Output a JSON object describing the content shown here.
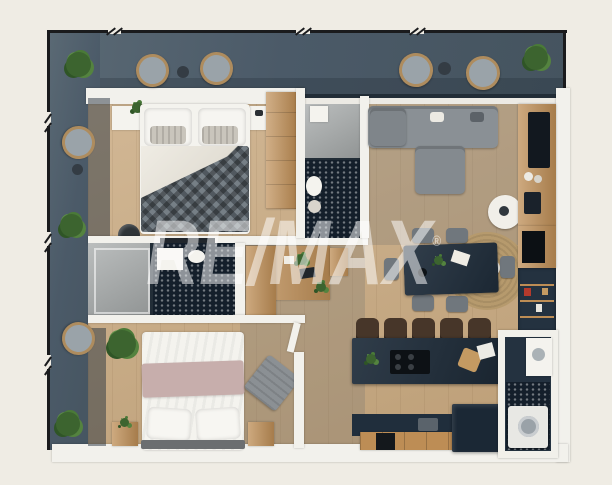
{
  "watermark": {
    "brand": "RE/MAX",
    "registered_symbol": "®",
    "color": "#ffffff"
  },
  "palette": {
    "page_background": "#efece4",
    "railing": "#1a1b1d",
    "balcony_floor": "#4f5e6c",
    "interior_wood_floor": "#c8a87e",
    "wall": "#f2f1ec",
    "navy_furniture": "#202e3c",
    "dark_hex_tile": "#141f2b",
    "sofa_gray": "#8a9095",
    "cabinet_wood": "#bd8d55",
    "plant_green": "#4a7a38",
    "bed2_throw_mauve": "#c7aeac"
  },
  "scene": {
    "kind": "3d-rendered-apartment-floor-plan-top-view",
    "rooms": [
      "wraparound-balcony",
      "bedroom-1",
      "bathroom-1",
      "bathroom-2",
      "bedroom-2",
      "living-room",
      "dining-area",
      "kitchen",
      "wc-laundry",
      "hallway"
    ],
    "furniture": [
      "double-bed-dark-duvet",
      "double-bed-white-duvet",
      "corner-sofa",
      "round-ottoman",
      "jute-rug",
      "side-table",
      "dining-table-6-chairs",
      "kitchen-island-5-stools",
      "cooktop",
      "kitchen-counter",
      "fridge",
      "washing-machine",
      "wardrobe",
      "desk",
      "tv-shelf",
      "bookshelf",
      "wicker-chairs",
      "potted-plants",
      "shower",
      "toilet",
      "sink",
      "bench",
      "nightstands",
      "pouf"
    ]
  }
}
